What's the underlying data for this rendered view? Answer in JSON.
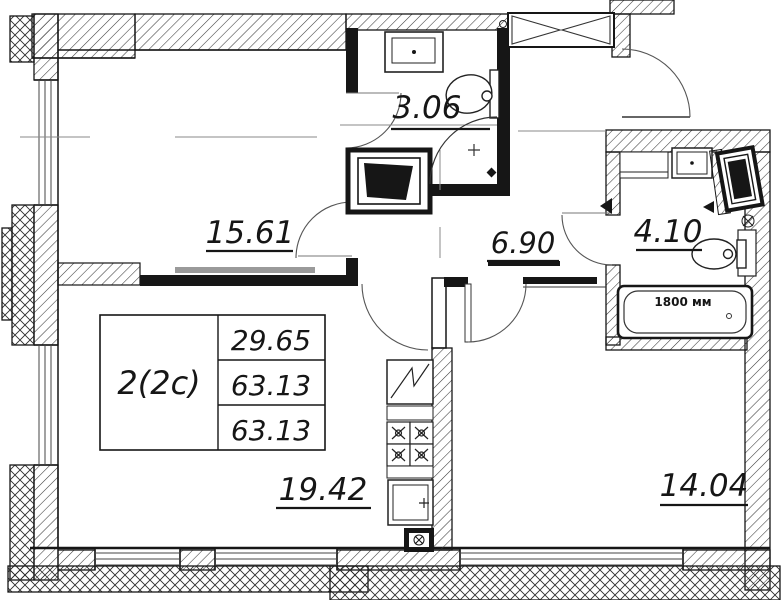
{
  "title": "Apartment floor plan",
  "unit_table": {
    "unit": "2(2c)",
    "area_row_1": "29.65",
    "area_row_2": "63.13",
    "area_row_3": "63.13"
  },
  "room_areas": {
    "living": "15.61",
    "wc": "3.06",
    "hall": "6.90",
    "bathroom": "4.10",
    "kitchen_living": "19.42",
    "bedroom": "14.04"
  },
  "annotations": {
    "bathtub_length": "1800 мм"
  },
  "colors": {
    "line": "#161616",
    "background": "#ffffff",
    "hatch": "#3a3a3a",
    "light_line": "#8a8a8a"
  }
}
